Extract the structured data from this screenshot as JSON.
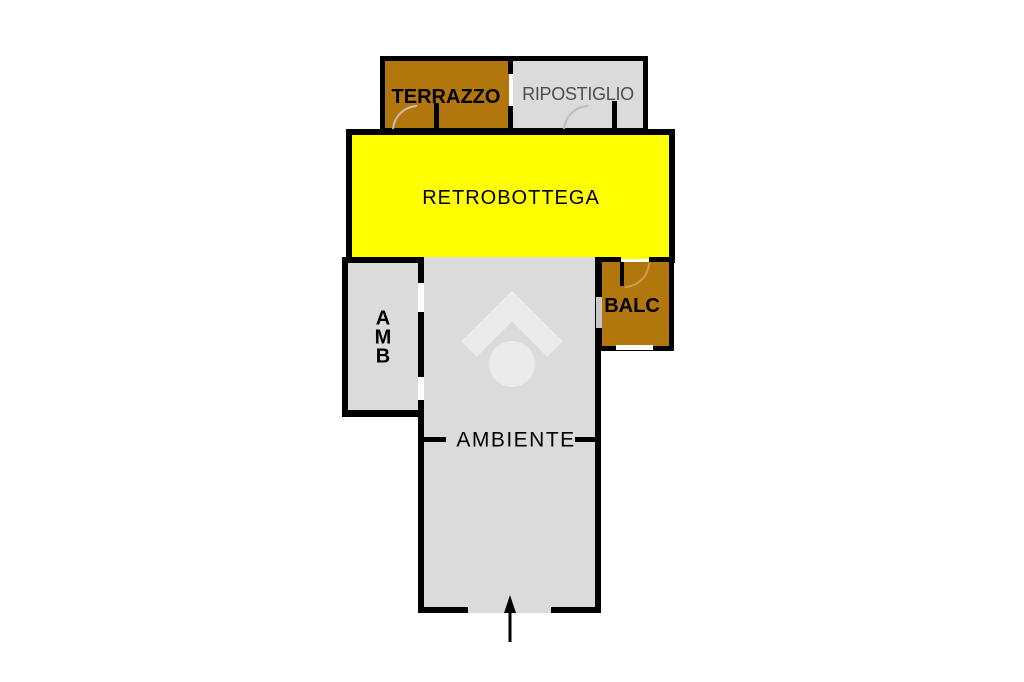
{
  "title": "commercial-unit-floor-plan",
  "colors": {
    "background": "#FFFFFF",
    "wall": "#000000",
    "balcony_brown": "#B1760C",
    "room_gray": "#DBDBDB",
    "highlight_yellow": "#FFFF00",
    "watermark_gray": "#EBEBEB",
    "secondary_text": "#4D4D4D"
  },
  "rooms": {
    "terrazzo": {
      "label": "TERRAZZO"
    },
    "ripostiglio": {
      "label": "RIPOSTIGLIO"
    },
    "retrobottega": {
      "label": "RETROBOTTEGA"
    },
    "amb": {
      "label": "AMB",
      "lines": [
        "A",
        "M",
        "B"
      ]
    },
    "balc": {
      "label": "BALC"
    },
    "ambiente": {
      "label": "AMBIENTE"
    }
  },
  "annotations": {
    "entrance_arrow_direction": "up",
    "watermark": "house-logo"
  }
}
